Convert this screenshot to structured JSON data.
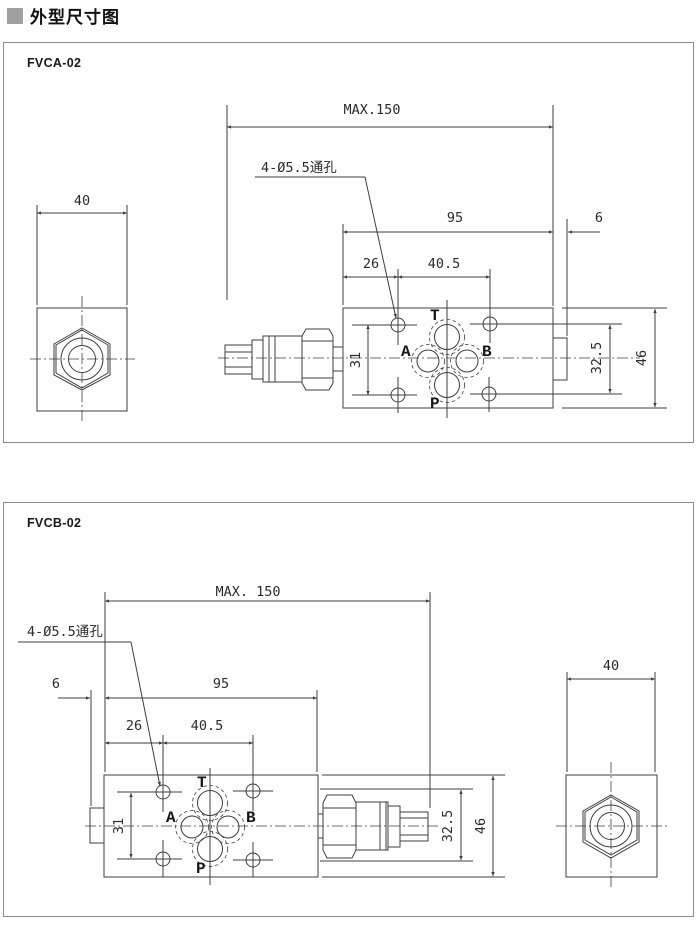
{
  "page": {
    "title": "外型尺寸图"
  },
  "colors": {
    "line": "#3f3f3f",
    "text": "#2b2b2b",
    "panel_border": "#8c8c8c",
    "title_square": "#a0a0a0",
    "bg": "#ffffff"
  },
  "panels": [
    {
      "model": "FVCA-02",
      "dims": {
        "max_length": "MAX.150",
        "mount_note": "4-Ø5.5通孔",
        "body_len": "95",
        "offset": "6",
        "hole_x1": "26",
        "hole_x2": "40.5",
        "block_w": "40",
        "hole_y": "31",
        "port_h": "32.5",
        "body_h": "46"
      },
      "ports": {
        "t": "T",
        "a": "A",
        "b": "B",
        "p": "P"
      }
    },
    {
      "model": "FVCB-02",
      "dims": {
        "max_length": "MAX. 150",
        "mount_note": "4-Ø5.5通孔",
        "body_len": "95",
        "offset": "6",
        "hole_x1": "26",
        "hole_x2": "40.5",
        "block_w": "40",
        "hole_y": "31",
        "port_h": "32.5",
        "body_h": "46"
      },
      "ports": {
        "t": "T",
        "a": "A",
        "b": "B",
        "p": "P"
      }
    }
  ]
}
